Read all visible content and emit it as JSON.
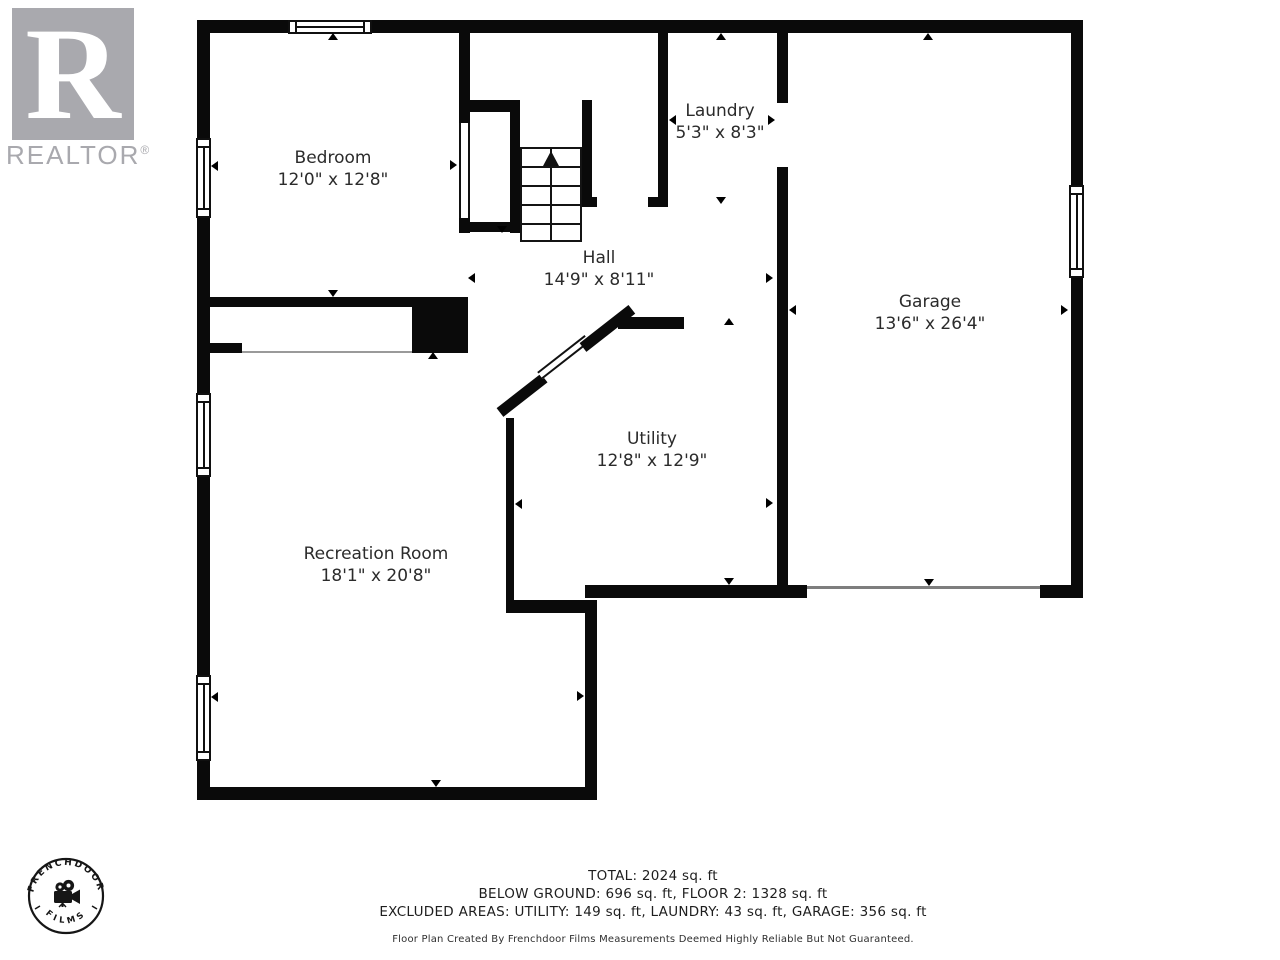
{
  "colors": {
    "wall": "#0a0a0a",
    "label_text": "#2b2b2b",
    "logo_gray": "#a9a9ae"
  },
  "realtor_logo": {
    "letter": "R",
    "wordmark": "REALTOR",
    "registered": "®"
  },
  "stamp": {
    "arc_top": "FRENCHDOOR",
    "arc_bottom": "FILMS"
  },
  "rooms": [
    {
      "name": "Bedroom",
      "dims": "12'0\" x 12'8\""
    },
    {
      "name": "Laundry",
      "dims": "5'3\" x 8'3\""
    },
    {
      "name": "Hall",
      "dims": "14'9\" x 8'11\""
    },
    {
      "name": "Garage",
      "dims": "13'6\" x 26'4\""
    },
    {
      "name": "Utility",
      "dims": "12'8\" x 12'9\""
    },
    {
      "name": "Recreation Room",
      "dims": "18'1\" x 20'8\""
    }
  ],
  "footer": {
    "line1": "TOTAL: 2024 sq. ft",
    "line2": "BELOW GROUND: 696 sq. ft, FLOOR 2: 1328 sq. ft",
    "line3": "EXCLUDED AREAS: UTILITY: 149 sq. ft, LAUNDRY: 43 sq. ft, GARAGE: 356 sq. ft",
    "line4": "Floor Plan Created By Frenchdoor Films Measurements Deemed Highly Reliable But Not Guaranteed."
  }
}
